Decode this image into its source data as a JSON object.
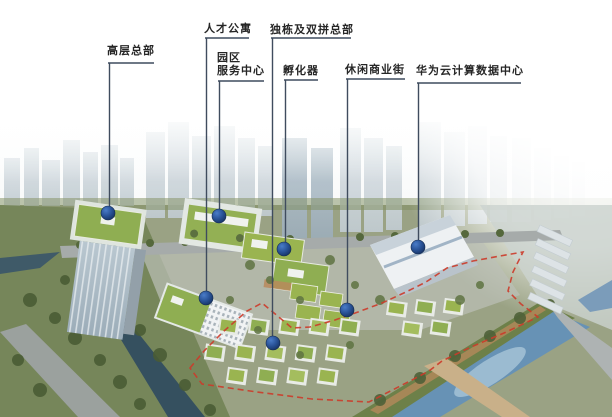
{
  "figure": {
    "type": "annotated-aerial-masterplan-rendering",
    "description_labels_visible_only": true
  },
  "annotations": [
    {
      "id": "high-rise-hq",
      "label": "高层总部"
    },
    {
      "id": "talent-apartments",
      "label": "人才公寓"
    },
    {
      "id": "detached-duplex-hq",
      "label": "独栋及双拼总部"
    },
    {
      "id": "park-service-center",
      "label": "园区\n服务中心"
    },
    {
      "id": "incubator",
      "label": "孵化器"
    },
    {
      "id": "leisure-commercial-street",
      "label": "休闲商业街"
    },
    {
      "id": "huawei-cloud-datacenter",
      "label": "华为云计算数据中心"
    }
  ],
  "colors": {
    "label_text": "#262626",
    "leader_line": "#3f4c5e",
    "marker_blue": "#1f4e8c",
    "boundary_red": "#cc3b2a",
    "roof_green": "#93b054",
    "water_blue": "#6792b5",
    "ghost_tower": "#ccd5da"
  }
}
